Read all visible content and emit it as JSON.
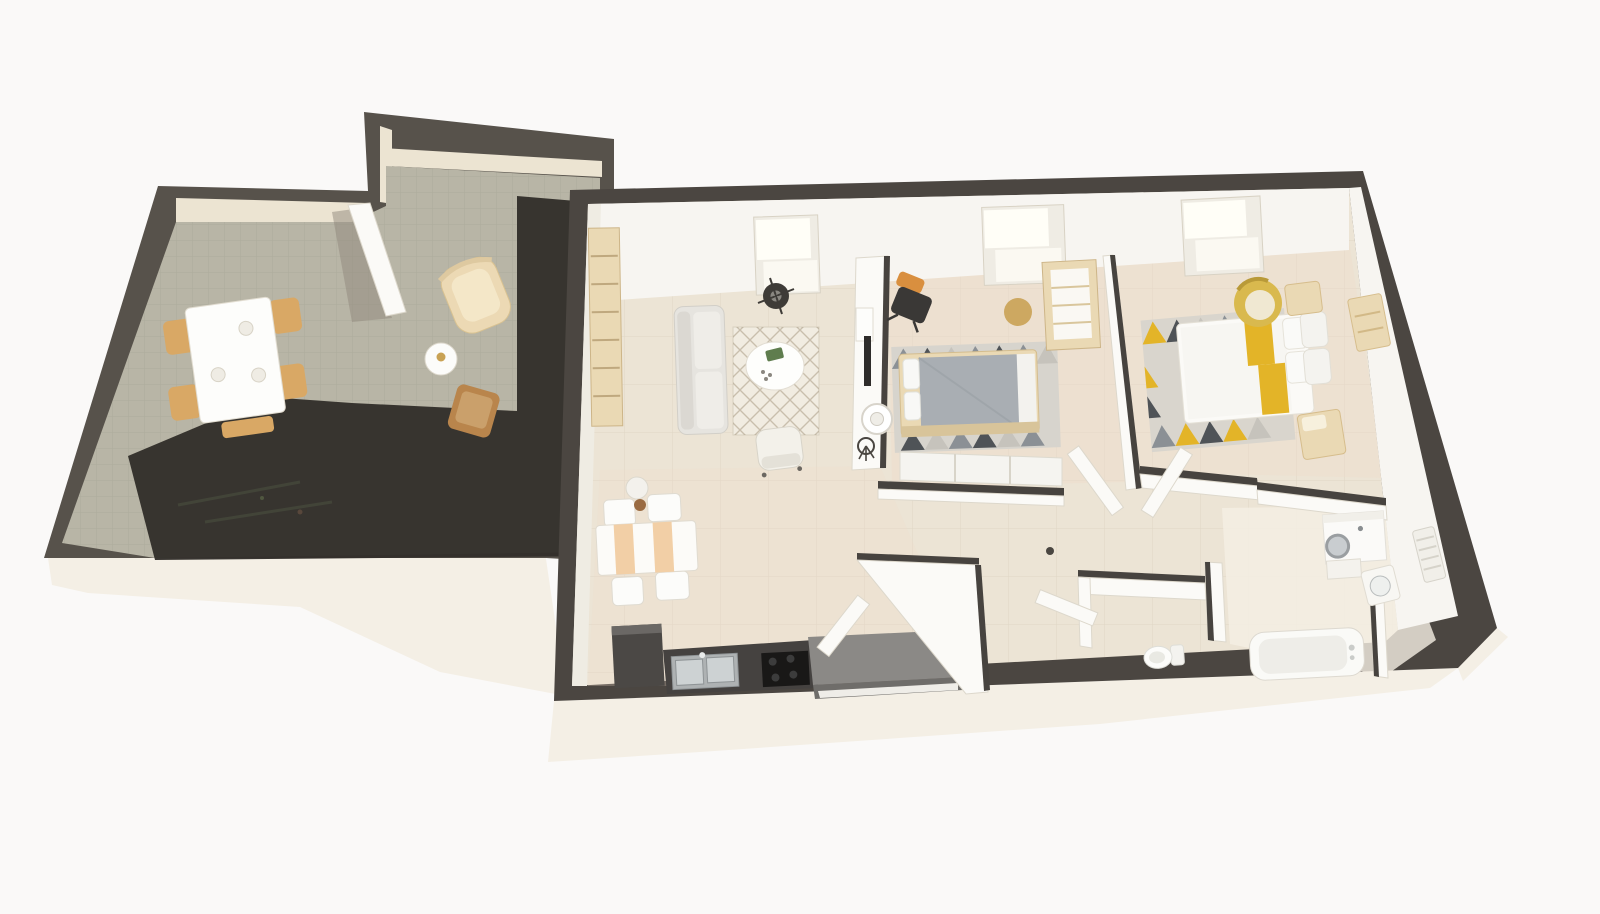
{
  "scene": {
    "type": "3d-floorplan-render",
    "view": "top-down tilted dollhouse view, no visible text or UI chrome",
    "roof_window_count": 3,
    "buildings": [
      {
        "id": "terrace-annex",
        "rooms": [
          {
            "id": "terrace",
            "furniture": [
              "outdoor-dining-table",
              "outdoor-dining-chairs-x4",
              "table-plates-x3",
              "wicker-lounge-chair",
              "round-side-table",
              "gold-tray",
              "wooden-accent-chair",
              "open-wall-panel",
              "cast-shadow"
            ]
          }
        ]
      },
      {
        "id": "main-apartment",
        "rooms": [
          {
            "id": "living-room",
            "furniture": [
              "bookshelf",
              "sofa",
              "lattice-rug",
              "round-coffee-table",
              "green-book",
              "armchair",
              "ceiling-fan-lamp",
              "tv-partition-wall",
              "television",
              "media-console",
              "decorative-plant",
              "pendant-lamp"
            ]
          },
          {
            "id": "kitchen-dining",
            "furniture": [
              "dining-table",
              "peach-table-runner",
              "dining-chairs-x4",
              "plant-stool",
              "tall-dark-cabinet",
              "kitchen-counter",
              "double-sink",
              "cooktop",
              "entry-sideboard"
            ]
          },
          {
            "id": "bedroom-1",
            "furniture": [
              "double-bed-gray-duvet",
              "white-pillows",
              "triangle-rug-gray",
              "desk-shelf-unit",
              "office-chair-orange-back",
              "round-gold-rug",
              "sliding-wardrobe"
            ]
          },
          {
            "id": "bedroom-2",
            "furniture": [
              "double-bed-yellow-runner",
              "white-pillows",
              "triangle-rug-yellow",
              "papasan-chair-gold",
              "bedside-cube-x2",
              "dresser"
            ]
          },
          {
            "id": "hallway",
            "furniture": [
              "open-door-panels-x4",
              "door-handle-dot"
            ]
          },
          {
            "id": "wc",
            "furniture": [
              "toilet"
            ]
          },
          {
            "id": "bathroom",
            "furniture": [
              "washing-machine",
              "bathroom-cabinet",
              "corner-sink",
              "towel-radiator",
              "bathtub"
            ]
          }
        ]
      }
    ]
  },
  "palette": {
    "bg": "#faf9f8",
    "wall_cap": "#57524b",
    "wall_cap_dark": "#4b4641",
    "wall_face": "#ece4d2",
    "white_wall": "#f7f5f1",
    "facade": "#f4efe5",
    "annex_floor": "#b8b5a6",
    "apt_floor": "#ece4d5",
    "bedroom_tint": "#efdccb",
    "shadow": "#332f2b",
    "wood_light": "#ead9b4",
    "wood_chair": "#d9a865",
    "wood_dark": "#b9854c",
    "gold": "#c9a254",
    "sofa_gray": "#e6e4df",
    "duvet_gray": "#a9aeb3",
    "counter_dark": "#454240",
    "steel": "#cdd2d3",
    "cooktop": "#191817",
    "yellow_accent": "#e3b428",
    "rug_dark": "#4f5357",
    "rug_mid": "#8b9095",
    "rug_light": "#c6c3bc",
    "window_bright": "#fffef7",
    "green_accent": "#5f7d4e",
    "orange_accent": "#d98f3f"
  }
}
